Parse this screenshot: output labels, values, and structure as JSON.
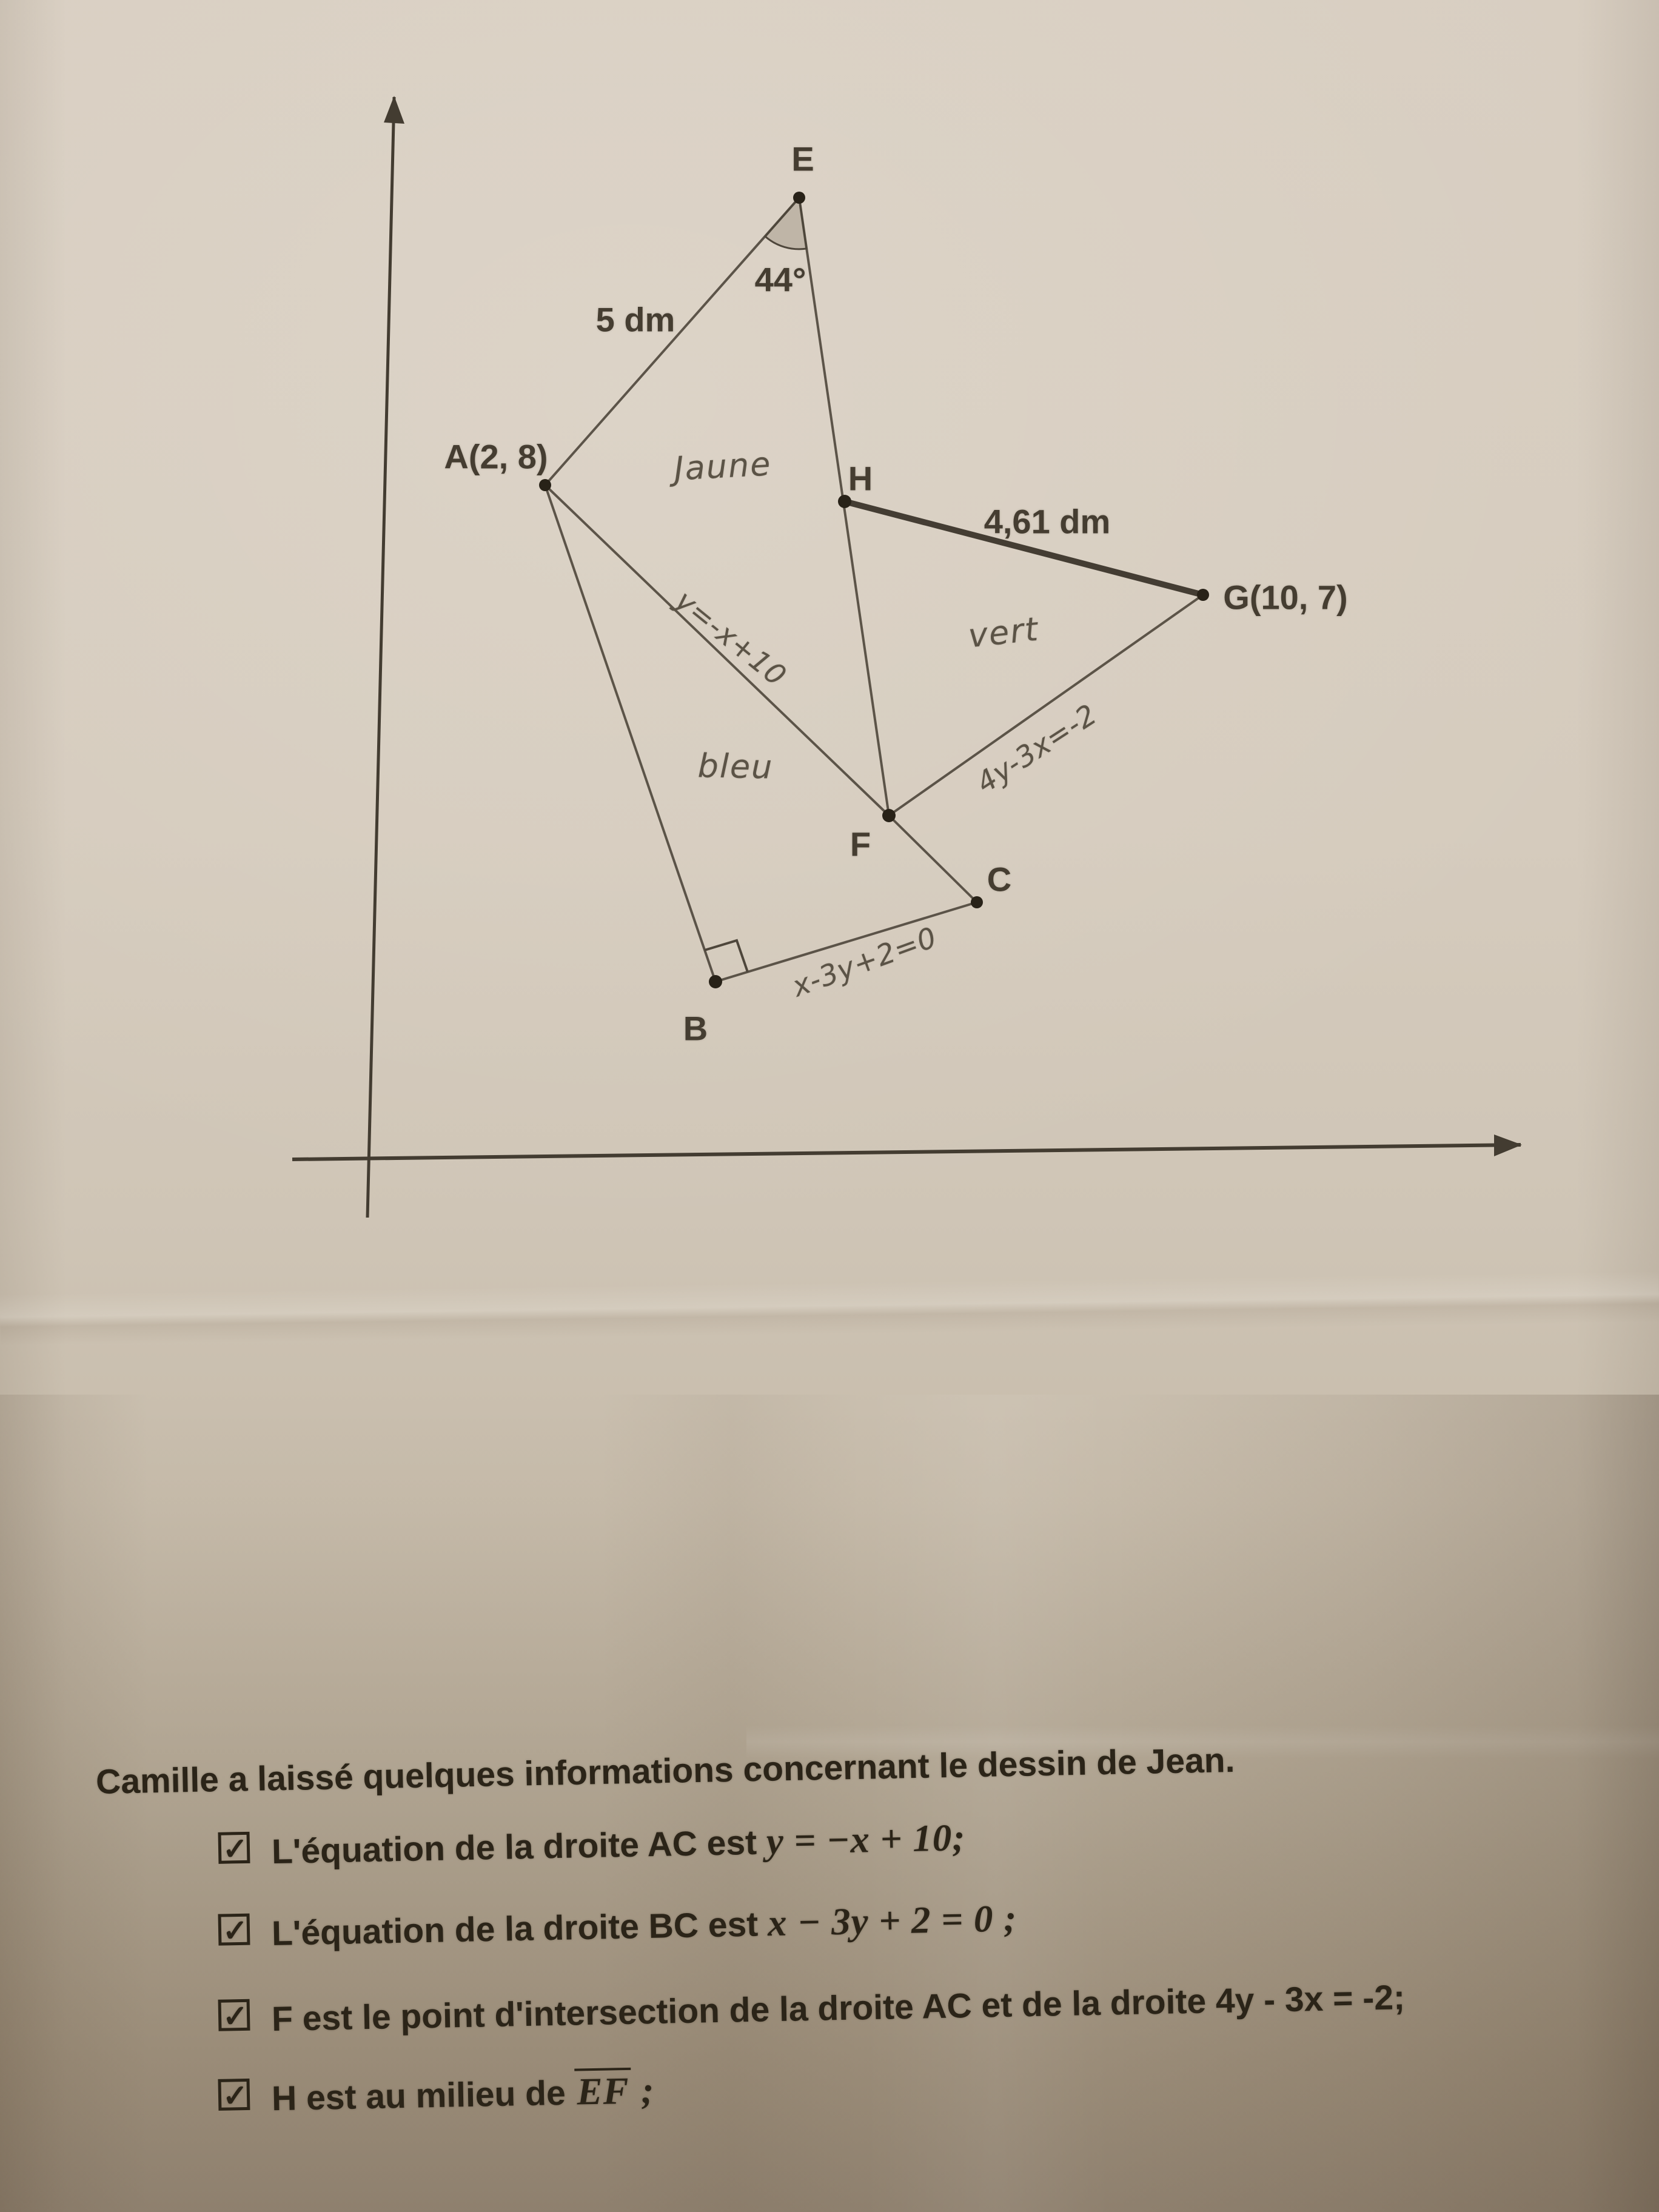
{
  "colors": {
    "ink": "#2b2418",
    "diagram_line": "#4e463b",
    "pencil": "#5b5346",
    "paper": "#d5cbbd"
  },
  "diagram": {
    "points": {
      "E": "E",
      "A": "A(2, 8)",
      "H": "H",
      "G": "G(10, 7)",
      "F": "F",
      "C": "C",
      "B": "B"
    },
    "measurements": {
      "ae_length": "5 dm",
      "angle_at_e": "44°",
      "hg_length": "4,61 dm"
    },
    "handwritten": {
      "yellow_region": "Jaune",
      "green_region": "vert",
      "blue_region": "bleu",
      "line_ac_equation": "y=-x+10",
      "line_fg_equation": "4y-3x=-2",
      "line_bc_equation": "x-3y+2=0"
    }
  },
  "notes": {
    "intro": "Camille a laissé quelques informations concernant le dessin de Jean.",
    "checkbox_glyph": "✓",
    "items": [
      {
        "text": "L'équation de la droite AC est ",
        "math": "y = −x + 10",
        "tail": ";"
      },
      {
        "text": "L'équation de la droite BC est ",
        "math": "x − 3y + 2 = 0",
        "tail": " ;"
      },
      {
        "text": "F est le point d'intersection de la droite AC et de la droite ",
        "math": "4y - 3x = -2",
        "tail": ";"
      },
      {
        "text": "H est au milieu de ",
        "math": "EF",
        "tail": " ;"
      }
    ]
  }
}
